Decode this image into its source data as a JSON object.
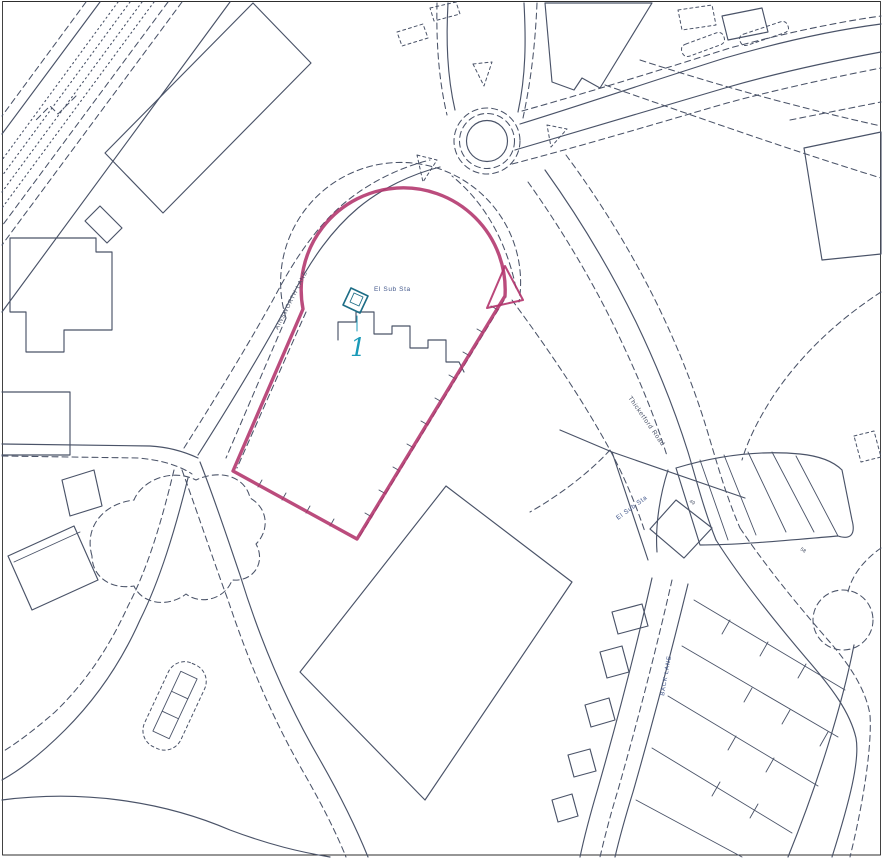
{
  "map": {
    "kind": "site-location-plan",
    "features": [
      "railway-corridor",
      "roundabout",
      "traffic-islands",
      "site-boundary-outline",
      "cul-de-sac-loop",
      "electricity-substation",
      "factory-buildings",
      "terraced-housing-plots",
      "scrubland-outline"
    ]
  },
  "colors": {
    "background": "#fdfdfc",
    "frame": "#2e2e2e",
    "map_line": "#4a5368",
    "site_boundary": "#b2336b",
    "marker_purple": "#5a4fa0",
    "label_blue": "#44598c",
    "plot_cyan": "#1a9ab8",
    "substation_teal": "#1d6d86"
  },
  "labels": {
    "el_sub_sta": "El Sub Sta",
    "plot_number": "1",
    "lane_west": "AINSWORTH LANE",
    "road_main": "Thicketford Road",
    "lane_east": "BACK LANE",
    "plot_49": "49",
    "plot_58": "58"
  }
}
